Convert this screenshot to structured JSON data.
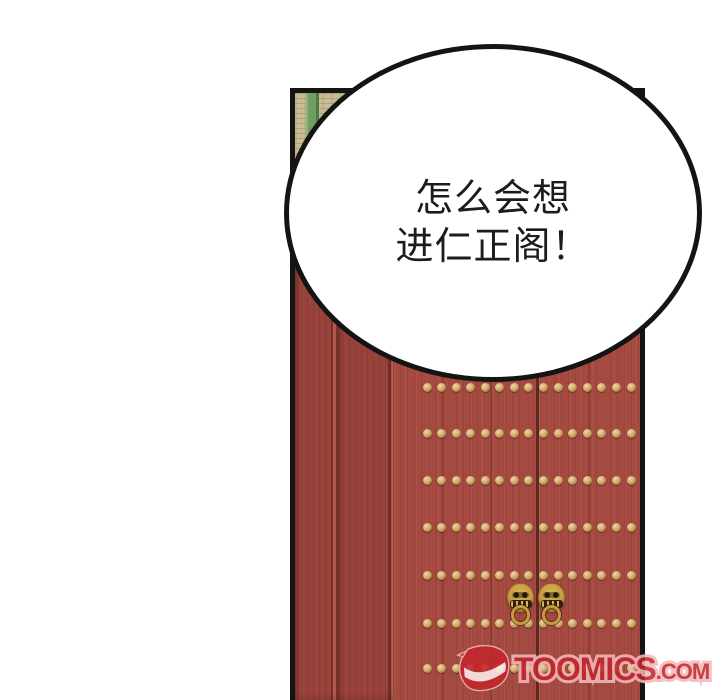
{
  "bubble": {
    "lines": [
      "怎么会想",
      "进仁正阁！"
    ],
    "text_color": "#1c1c1c",
    "fill": "#ffffff",
    "outline": "#141414"
  },
  "scene": {
    "description": "black-framed comic panel: red palace double door with gold stud rows and two lion-head ring knockers, tan woven lintel with green stripe at top-left",
    "colors": {
      "panel_border": "#141414",
      "door_red": "#a54a40",
      "post_red": "#9a433c",
      "groove_dark": "#7a332d",
      "seam_dark": "#5f2722",
      "mat_tan": "#c9bd98",
      "mat_line": "#82704a",
      "stripe_green": "#6f9e62",
      "stud_gold": "#d4ad6f",
      "stud_gold_dark": "#6f4f22",
      "knocker_gold": "#c79a3f"
    },
    "studs": {
      "rows_y": [
        387,
        433,
        480,
        527,
        575,
        623,
        668
      ],
      "cols_x": [
        427,
        441,
        456,
        470,
        485,
        499,
        514,
        528,
        543,
        558,
        572,
        587,
        601,
        616,
        631
      ],
      "diameter": 9
    },
    "planks": {
      "lines_x": [
        442,
        490,
        588
      ],
      "seam_x": 536,
      "top_y": 267
    },
    "knockers": [
      {
        "cx": 521,
        "cy": 597
      },
      {
        "cx": 552,
        "cy": 597
      }
    ]
  },
  "watermark": {
    "logo": "toomics-logo",
    "text": "TOOMICS",
    "suffix": ".COM",
    "fill": "#c2262c",
    "outline": "#f2b9bd"
  }
}
